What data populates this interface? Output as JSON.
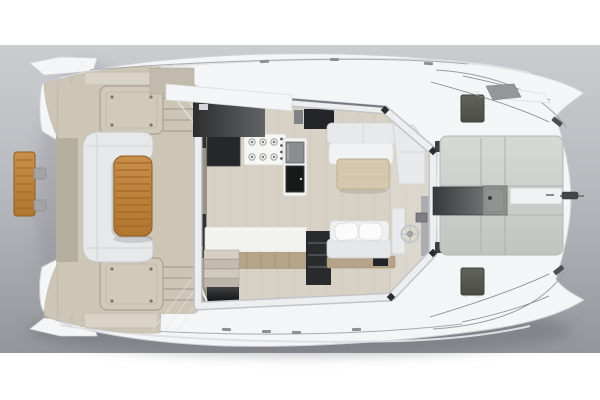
{
  "image": {
    "type": "3d-render",
    "subject": "Power catamaran deck plan, overhead top-down rendering",
    "orientation": "bow pointing right, stern at left",
    "width_px": 600,
    "height_px": 400
  },
  "palette": {
    "page_bg": "#ffffff",
    "backdrop_top": "#cbccd0",
    "backdrop_mid": "#b9babf",
    "backdrop_bottom": "#94959b",
    "hull_white": "#f4f5f7",
    "hull_edge": "#cfd0d4",
    "deck_beige": "#cdc6b6",
    "deck_beige_dark": "#aaa393",
    "teak": "#c08544",
    "teak_dark": "#96611f",
    "seat_white": "#e7e8ea",
    "cushion_white": "#fbfbfc",
    "salon_floor": "#d8d1c5",
    "frame_silver": "#edeef0",
    "frame_edge": "#c3c4c8",
    "charcoal": "#39393b",
    "appliance_black": "#181919",
    "appliance_steel": "#8a8c8e",
    "counter_white": "#f2f2f0",
    "counter_wood": "#b5a489",
    "shelf_dark": "#292a2c",
    "panel_gray": "#cfd1cf",
    "panel_seam": "#aeb0ae",
    "walkway_dark": "#3c3d3f",
    "hatch_gray": "#53544e",
    "rail_gray": "#9b9ca0",
    "shadow": "#5f616b"
  },
  "scene": {
    "backdrop": {
      "label": "studio backdrop with white bands top and bottom"
    },
    "stern": {
      "label": "twin swim platforms with boarding steps",
      "features": [
        "swim-platform-port",
        "swim-platform-starboard",
        "teak boarding gangway",
        "gangway clips"
      ]
    },
    "aft_cockpit": {
      "label": "aft cockpit",
      "features": [
        "C-shaped settee",
        "teak slatted table",
        "deck locker port",
        "deck locker starboard",
        "boarding steps",
        "grab rails"
      ]
    },
    "salon": {
      "label": "salon and galley under silver windscreen frame",
      "features": [
        "refrigerator cabinet",
        "gas stove with burners",
        "oven and microwave column",
        "galley counter with wood front",
        "storage shelves",
        "companionway stairs",
        "L-shaped sofa",
        "salon table",
        "helm bench with two pillows",
        "helm wheel",
        "helm console",
        "aft sliding-door entry",
        "white roof overhang"
      ]
    },
    "foredeck": {
      "label": "foredeck and bow lounge",
      "features": [
        "gray sunpad panels",
        "dark center walkway",
        "anchor locker hatch",
        "white bow step panel",
        "deck hatch port",
        "deck hatch starboard",
        "bow cleats",
        "anchor roller",
        "bow rails",
        "roof winglet",
        "twin bow wings"
      ]
    }
  }
}
